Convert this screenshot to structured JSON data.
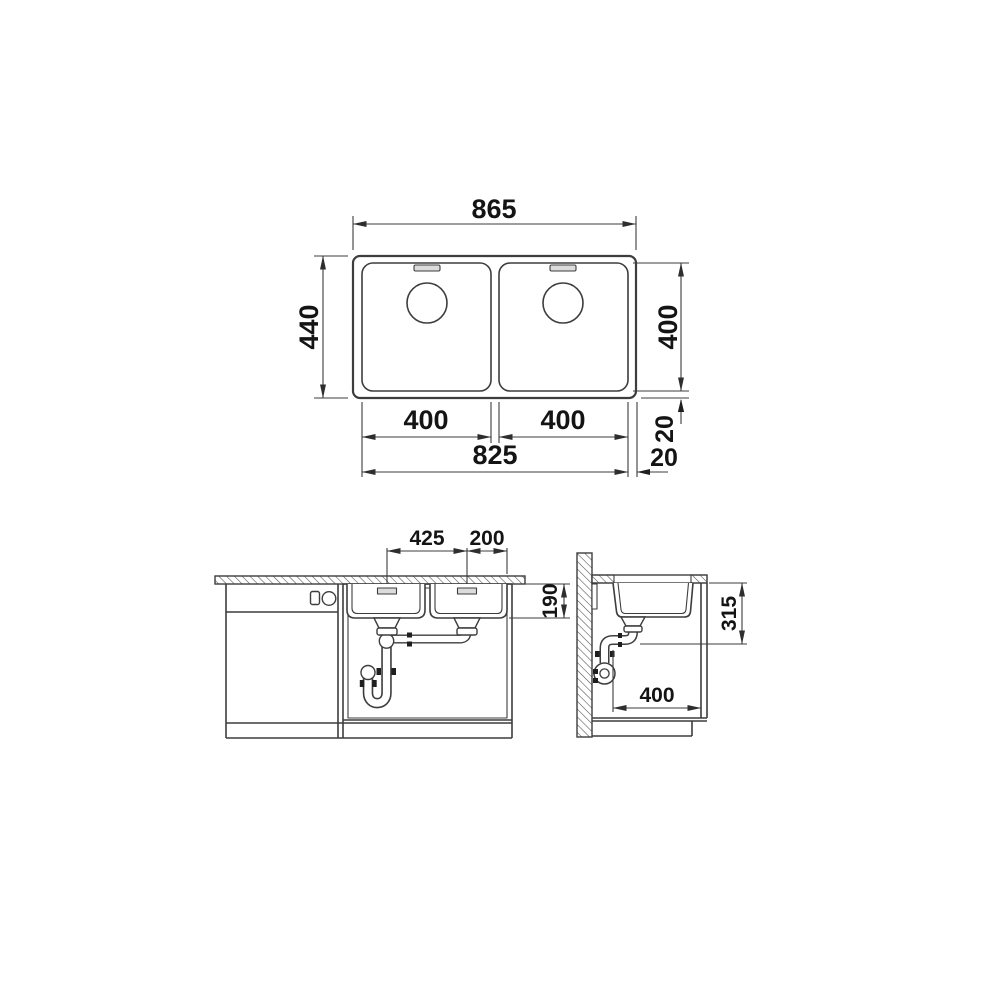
{
  "dimensions": {
    "top_view": {
      "total_width": "865",
      "total_depth": "440",
      "bowl_depth": "400",
      "left_bowl_width": "400",
      "right_bowl_width": "400",
      "bowls_span": "825",
      "rim_bottom": "20",
      "rim_right": "20"
    },
    "front_view": {
      "drain_spacing": "425",
      "drain_to_edge": "200",
      "bowl_inner_depth": "190"
    },
    "side_view": {
      "drain_height": "315",
      "base_depth": "400"
    }
  }
}
